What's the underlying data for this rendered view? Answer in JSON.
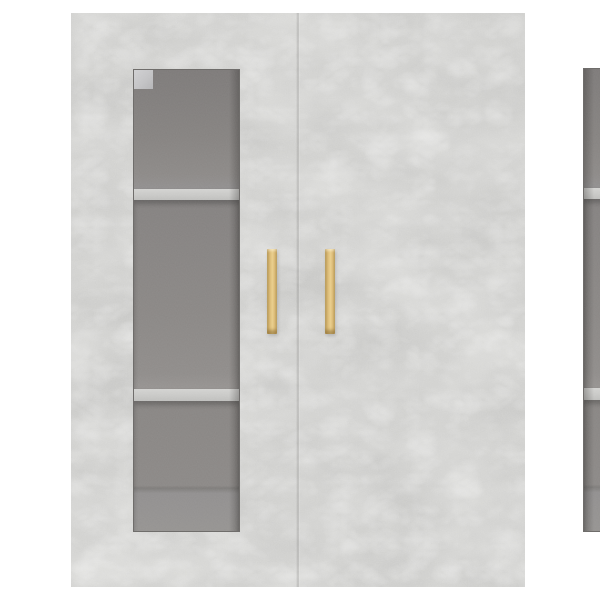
{
  "scene": {
    "type": "product-photo",
    "subject": "wall-mounted cabinet with two glass doors",
    "background": "#ffffff"
  },
  "colors": {
    "background": "#ffffff",
    "concrete_base": "#c6c6c4",
    "concrete_light": "#dcdcda",
    "concrete_dark": "#b2b2b0",
    "interior_top": "#7e7b7a",
    "interior_mid": "#8d8a88",
    "interior_light": "#969492",
    "shelf": "#c8c8c6",
    "seam": "#9c9a98",
    "glass_edge": "#585654",
    "handle_dark": "#bf9c53",
    "handle_mid": "#dcbc78",
    "handle_light": "#eacf8e",
    "corner_highlight": "#d0d0d2",
    "corner_dot": "#504d4a"
  },
  "cabinet": {
    "finish": "concrete gray",
    "door_count": 2,
    "doors": [
      {
        "id": "left",
        "glass_panel": true,
        "shelves_visible": 2,
        "compartments": 3,
        "handle_finish": "light wood"
      },
      {
        "id": "right",
        "glass_panel": true,
        "shelves_visible": 2,
        "compartments": 3,
        "handle_finish": "light wood"
      }
    ]
  }
}
